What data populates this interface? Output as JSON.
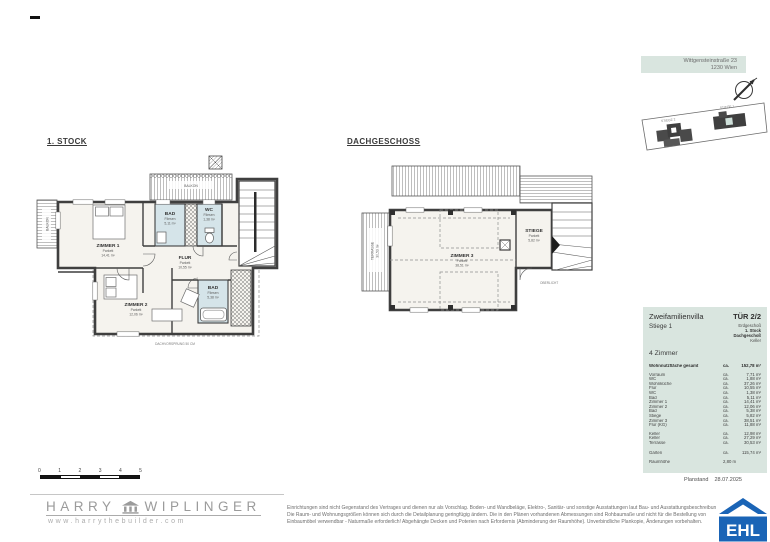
{
  "header": {
    "address_line1": "Wittgensteinstraße 23",
    "address_line2": "1230 Wien"
  },
  "site_plan": {
    "stiege2_label": "STIEGE 2",
    "stiege1_label": "STIEGE 1"
  },
  "plan_first": {
    "title": "1. STOCK",
    "balkon_top": "BALKON",
    "balkon_left": "BALKON",
    "rooms": {
      "zimmer1": {
        "name": "ZIMMER 1",
        "floor": "Parkett",
        "area": "14,41 m²"
      },
      "bad": {
        "name": "BAD",
        "floor": "Fliesen",
        "area": "5,11 m²"
      },
      "wc": {
        "name": "WC",
        "floor": "Fliesen",
        "area": "1,38 m²"
      },
      "flur": {
        "name": "FLUR",
        "floor": "Parkett",
        "area": "10,55 m²"
      },
      "zimmer2": {
        "name": "ZIMMER 2",
        "floor": "Parkett",
        "area": "12,06 m²"
      },
      "bad2": {
        "name": "BAD",
        "floor": "Fliesen",
        "area": "5,38 m²"
      }
    },
    "note": "DACHVORSPRUNG 50 CM"
  },
  "plan_attic": {
    "title": "DACHGESCHOSS",
    "terrasse": "TERRASSE",
    "terrasse_area": "30,53 m²",
    "rooms": {
      "zimmer3": {
        "name": "ZIMMER 3",
        "floor": "Parkett",
        "area": "38,51 m²"
      },
      "stiege": {
        "name": "STIEGE",
        "floor": "Parkett",
        "area": "5,82 m²"
      }
    },
    "note": "OBERLICHT"
  },
  "title_block": {
    "project": "Zweifamilienvilla",
    "tuer": "TÜR 2/2",
    "stiege": "Stiege 1",
    "floors": [
      {
        "label": "Erdgeschoß"
      },
      {
        "label": "1. Stock"
      },
      {
        "label": "Dachgeschoß"
      },
      {
        "label": "Keller"
      }
    ],
    "zimmer_count": "4 Zimmer",
    "total": {
      "label": "Wohnnutzfläche gesamt",
      "ca": "ca.",
      "value": "152,78 m²"
    },
    "rows": [
      {
        "label": "Vorraum",
        "ca": "ca.",
        "value": "7,71 m²"
      },
      {
        "label": "WC",
        "ca": "ca.",
        "value": "1,88 m²"
      },
      {
        "label": "Wohnküche",
        "ca": "ca.",
        "value": "37,26 m²"
      },
      {
        "label": "Flur",
        "ca": "ca.",
        "value": "10,55 m²"
      },
      {
        "label": "WC",
        "ca": "ca.",
        "value": "1,38 m²"
      },
      {
        "label": "Bad",
        "ca": "ca.",
        "value": "5,11 m²"
      },
      {
        "label": "Zimmer 1",
        "ca": "ca.",
        "value": "14,41 m²"
      },
      {
        "label": "Zimmer 2",
        "ca": "ca.",
        "value": "12,06 m²"
      },
      {
        "label": "Bad",
        "ca": "ca.",
        "value": "5,38 m²"
      },
      {
        "label": "Stiege",
        "ca": "ca.",
        "value": "5,82 m²"
      },
      {
        "label": "Zimmer 3",
        "ca": "ca.",
        "value": "38,51 m²"
      },
      {
        "label": "Flur (KG)",
        "ca": "ca.",
        "value": "11,88 m²"
      }
    ],
    "rows_extra": [
      {
        "label": "Keller",
        "ca": "ca.",
        "value": "12,98 m²"
      },
      {
        "label": "Keller",
        "ca": "ca.",
        "value": "27,29 m²"
      },
      {
        "label": "Terrasse",
        "ca": "ca.",
        "value": "30,53 m²"
      }
    ],
    "garten": {
      "label": "Garten",
      "ca": "ca.",
      "value": "115,74 m²"
    },
    "raumhoehe": {
      "label": "Raumhöhe",
      "value": "2,80 m"
    },
    "planstand_label": "Planstand",
    "planstand_date": "28.07.2025"
  },
  "scale_bar": {
    "ticks": [
      "0",
      "1",
      "2",
      "3",
      "4",
      "5"
    ]
  },
  "footer": {
    "brand_first": "HARRY",
    "brand_last": "WIPLINGER",
    "brand_url": "www.harrythebuilder.com",
    "disclaimer": [
      "Einrichtungen sind nicht Gegenstand des Vertrages und dienen nur als Vorschlag. Boden- und Wandbeläge, Elektro-, Sanitär- und sonstige Ausstattungen laut Bau- und Ausstattungsbeschreibung.",
      "Die Raum- und Wohnungsgrößen können sich durch die Detailplanung geringfügig ändern. Die in den Plänen vorhandenen Abmessungen sind Rohbaumaße und nicht für die Bestellung von",
      "Einbaumöbel verwendbar - Naturmaße erforderlich! Abgehängte Decken und Poterien nach Erfordernis (Abminderung der Raumhöhe). Unverbindliche Plankopie, Änderungen vorbehalten."
    ]
  },
  "ehl_logo": {
    "label": "EHL"
  },
  "colors": {
    "band_green": "#d9e5df",
    "bath_blue": "#d5e4e9",
    "floor_beige": "#f5f3ee",
    "ehl_blue": "#1a64b6",
    "wall_gray": "#3f3f3f"
  }
}
